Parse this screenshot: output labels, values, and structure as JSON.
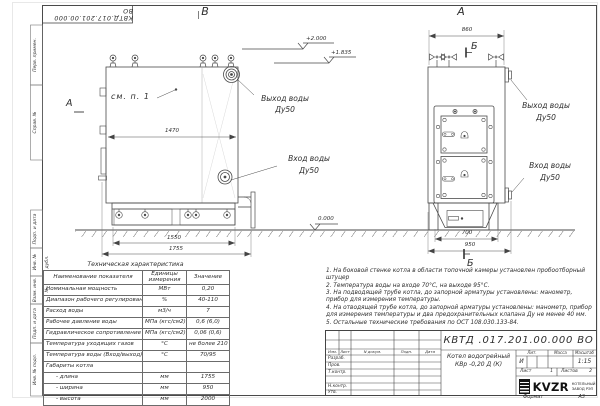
{
  "frame": {
    "doc_number_top": "КВТД.017.201.00.000  ВО",
    "side_labels": [
      "Перв. примен.",
      "Справ. №",
      "Подп. и дата",
      "Инв. № дубл.",
      "Взам. инв. №",
      "Подп. и дата",
      "Инв. № подл."
    ]
  },
  "left_view": {
    "title": "В",
    "arrow_label": "А",
    "detail_note": "см. п. 1",
    "outlet_line1": "Выход воды",
    "outlet_line2": "Ду50",
    "inlet_line1": "Вход воды",
    "inlet_line2": "Ду50",
    "dim_top": "1470",
    "dim_base": "1550",
    "dim_overall": "1755",
    "elev_top": "+2.000",
    "elev_mid": "+1.835",
    "elev_ground": "0.000"
  },
  "right_view": {
    "title": "А",
    "section_top": "Б",
    "section_bottom": "Б",
    "outlet_line1": "Выход воды",
    "outlet_line2": "Ду50",
    "inlet_line1": "Вход воды",
    "inlet_line2": "Ду50",
    "dim_top": "860",
    "dim_inner": "700",
    "dim_base": "950"
  },
  "spec_table": {
    "title": "Техническая характеристика",
    "headers": [
      "Наименование показателя",
      "Единицы измерения",
      "Значение"
    ],
    "rows": [
      [
        "Номинальная мощность",
        "МВт",
        "0,20"
      ],
      [
        "Диапазон рабочего регулирования",
        "%",
        "40-110"
      ],
      [
        "Расход воды",
        "м3/ч",
        "7"
      ],
      [
        "Рабочее давление воды",
        "МПа (кгс/см2)",
        "0,6 (6,0)"
      ],
      [
        "Гидравлическое сопротивление котла",
        "МПа (кгс/см2)",
        "0,06 (0,6)"
      ],
      [
        "Температура уходящих газов",
        "°С",
        "не более 210"
      ],
      [
        "Температура воды (Вход/выход)",
        "°С",
        "70/95"
      ],
      [
        "Габариты котла",
        "",
        ""
      ],
      [
        "- длина",
        "мм",
        "1755"
      ],
      [
        "- ширина",
        "мм",
        "950"
      ],
      [
        "- высота",
        "мм",
        "2000"
      ]
    ]
  },
  "notes": [
    "1.  На боковой стенке котла в области топочной камеры установлен пробоотборный штуцер",
    "2.  Температура воды на входе 70°С,  на выходе 95°С.",
    "3.  На подводящей трубе котла, до запорной арматуры установлены: манометр, прибор для измерения температуры.",
    "4.  На отводящей трубе котла, до запорной арматуры установлены: манометр, прибор для измерения температуры и два предохранительных клапана  Ду не менее 40 мм.",
    "5.  Остальные технические требования по ОСТ  108.030.133-84."
  ],
  "title_block": {
    "doc_number": "КВТД .017.201.00.000  ВО",
    "product_line1": "Котел водогрейный",
    "product_line2": "КВр -0,20  Д  (К)",
    "cols": [
      "Изм.",
      "Лист",
      "N докум.",
      "Подп.",
      "Дата"
    ],
    "rows": [
      "Разраб.",
      "Пров.",
      "Т.контр.",
      "Н.контр.",
      "Утв."
    ],
    "lit_label": "Лит.",
    "mass_label": "Масса",
    "scale_label": "Масштаб",
    "lit_value": "И",
    "scale_value": "1:15",
    "sheet_label": "Лист",
    "sheet_value": "1",
    "sheets_label": "Листов",
    "sheets_value": "2",
    "brand": "KVZR",
    "company_line1": "КОТЕЛЬНЫЙ",
    "company_line2": "ЗАВОД РЭП",
    "format_label": "Формат",
    "format_value": "А3"
  }
}
